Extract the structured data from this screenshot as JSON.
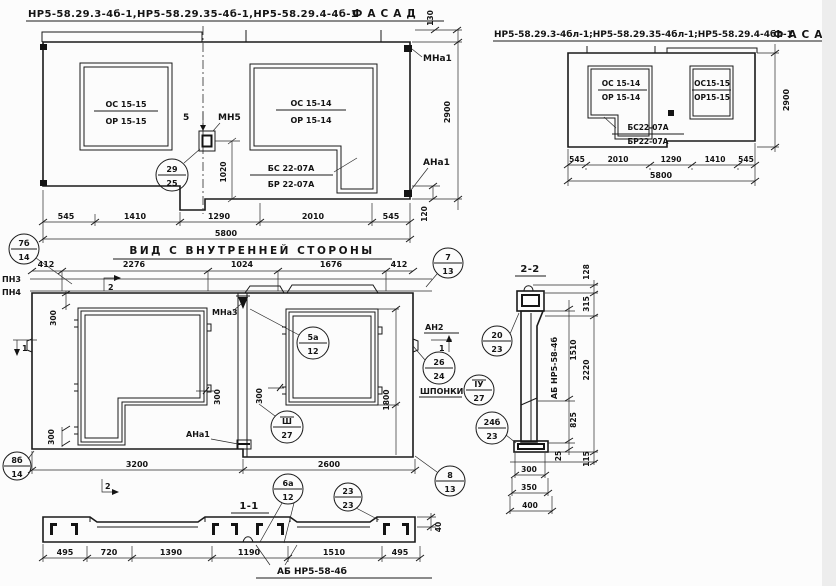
{
  "elevA": {
    "title": "НР5-58.29.3-4б-1,НР5-58.29.35-4б-1,НР5-58.29.4-4б-1",
    "view": "ФАСАД",
    "win_left_top": "ОС 15-15",
    "win_left_bot": "ОР 15-15",
    "win_right_top": "ОС 15-14",
    "win_right_bot": "ОР 15-14",
    "sill_top": "БС 22-07А",
    "sill_bot": "БР 22-07А",
    "mark5": "5",
    "mn5": "МН5",
    "mna1": "МНа1",
    "ana1": "АНа1",
    "c29": {
      "top": "29",
      "bot": "25"
    },
    "dim130": "130",
    "dim2900": "2900",
    "dim120": "120",
    "dim1020": "1020",
    "dims": [
      "545",
      "1410",
      "1290",
      "2010",
      "545"
    ],
    "total": "5800"
  },
  "elevB": {
    "title": "НР5-58.29.3-4бл-1;НР5-58.29.35-4бл-1;НР5-58.29.4-4бл-1",
    "view": "ФАСАД",
    "win_left_top": "ОС 15-14",
    "win_left_bot": "ОР 15-14",
    "sill_top": "БС22-07А",
    "sill_bot": "БР22-07А",
    "win_right_top": "ОС15-15",
    "win_right_bot": "ОР15-15",
    "dims": [
      "545",
      "2010",
      "1290",
      "1410",
      "545"
    ],
    "total": "5800",
    "dim2900": "2900"
  },
  "mid": {
    "title": "ВИД С ВНУТРЕННЕЙ СТОРОНЫ",
    "dims_top": [
      "412",
      "2276",
      "1024",
      "1676",
      "412"
    ],
    "pn3": "ПН3",
    "pn4": "ПН4",
    "mna3": "МНа3",
    "ana1": "АНа1",
    "an2": "АН2",
    "shponki": "ШПОНКИ",
    "sec1": "1",
    "sec2": "2",
    "c7b": {
      "top": "7б",
      "bot": "14"
    },
    "c7": {
      "top": "7",
      "bot": "13"
    },
    "c5a": {
      "top": "5а",
      "bot": "12"
    },
    "c3": {
      "top": "Ш",
      "bot": "27"
    },
    "c4": {
      "top": "ІУ",
      "bot": "27"
    },
    "c26": {
      "top": "26",
      "bot": "24"
    },
    "c8": {
      "top": "8",
      "bot": "13"
    },
    "c8b": {
      "top": "8б",
      "bot": "14"
    },
    "dim300": "300",
    "dim1800": "1800",
    "dim3200": "3200",
    "dim2600": "2600"
  },
  "s11": {
    "title": "1-1",
    "dims": [
      "495",
      "720",
      "1390",
      "1190",
      "1510",
      "495"
    ],
    "dim40": "40",
    "label": "АБ НР5-58-4б",
    "c6a": {
      "top": "6а",
      "bot": "12"
    },
    "c23": {
      "top": "23",
      "bot": "23"
    }
  },
  "s22": {
    "title": "2-2",
    "label": "АБ НР5-58-4б",
    "c20": {
      "top": "20",
      "bot": "23"
    },
    "c24b": {
      "top": "24б",
      "bot": "23"
    },
    "dim128": "128",
    "dim315": "315",
    "dim1510": "1510",
    "dim2220": "2220",
    "dim825": "825",
    "dim25": "25",
    "dim115": "115",
    "dims_bottom": [
      "300",
      "350",
      "400"
    ]
  }
}
